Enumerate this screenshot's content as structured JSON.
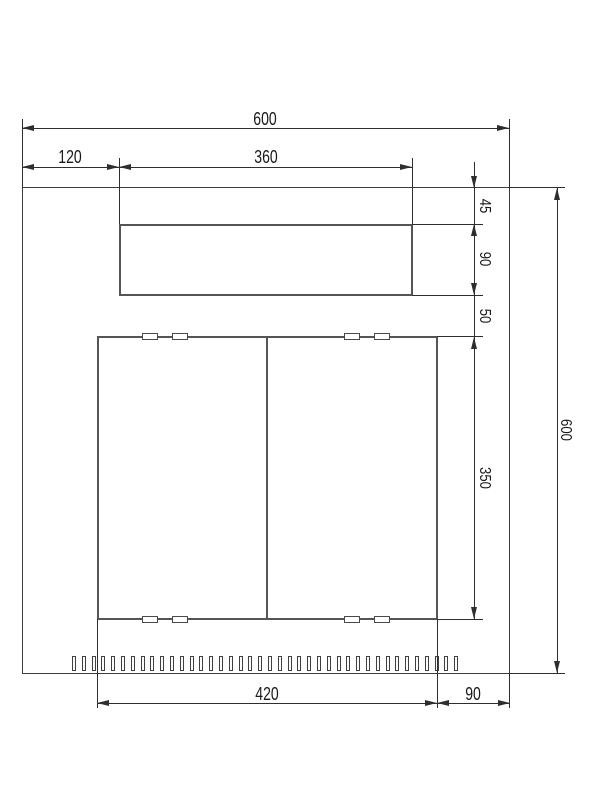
{
  "drawing": {
    "dims": {
      "top_width": "600",
      "top_left_offset": "120",
      "top_cutout_width": "360",
      "right_top_margin": "45",
      "right_cutout_height": "90",
      "right_gap": "50",
      "right_door_height": "350",
      "right_total_height": "600",
      "bottom_door_width": "420",
      "bottom_right_offset": "90"
    },
    "features": {
      "vent_slot_count": 40,
      "clip_tabs_per_edge": 4,
      "clip_tab_edges": 2
    },
    "colors": {
      "background": "#ffffff",
      "part_edge": "#555555",
      "panel_edge": "#3d3d3d",
      "dimension_line": "#2e2e2e",
      "text": "#1a1a1a"
    }
  }
}
